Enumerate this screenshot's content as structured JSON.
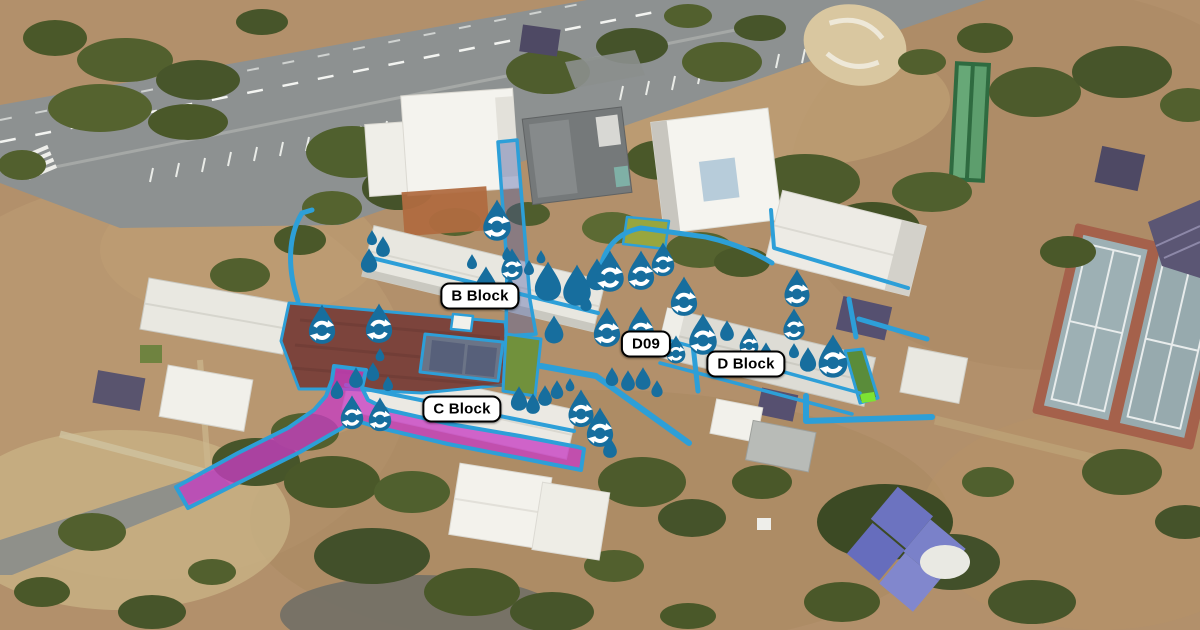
{
  "map": {
    "kind": "aerial-campus-map",
    "labels": [
      {
        "id": "b-block",
        "text": "B Block",
        "x": 480,
        "y": 296
      },
      {
        "id": "c-block",
        "text": "C Block",
        "x": 462,
        "y": 409
      },
      {
        "id": "d09",
        "text": "D09",
        "x": 646,
        "y": 344
      },
      {
        "id": "d-block",
        "text": "D Block",
        "x": 746,
        "y": 364
      }
    ],
    "colors": {
      "marker_blue": "#176e9e",
      "pipe_blue": "#2d9fd8",
      "path_magenta": "#c43ec2",
      "highlight_green": "#7de332",
      "label_background": "#ffffff",
      "label_border": "#000000",
      "label_text": "#000000"
    },
    "markers": [
      {
        "type": "water-drop",
        "x": 372,
        "y": 238,
        "size": 16
      },
      {
        "type": "water-drop",
        "x": 383,
        "y": 247,
        "size": 22
      },
      {
        "type": "water-drop",
        "x": 369,
        "y": 261,
        "size": 26
      },
      {
        "type": "recycle-drop",
        "x": 322,
        "y": 325,
        "size": 42
      },
      {
        "type": "recycle-drop",
        "x": 379,
        "y": 324,
        "size": 42
      },
      {
        "type": "water-drop",
        "x": 380,
        "y": 355,
        "size": 14
      },
      {
        "type": "water-drop",
        "x": 373,
        "y": 372,
        "size": 20
      },
      {
        "type": "water-drop",
        "x": 388,
        "y": 384,
        "size": 16
      },
      {
        "type": "water-drop",
        "x": 337,
        "y": 390,
        "size": 20
      },
      {
        "type": "water-drop",
        "x": 356,
        "y": 378,
        "size": 22
      },
      {
        "type": "recycle-drop",
        "x": 352,
        "y": 413,
        "size": 36
      },
      {
        "type": "recycle-drop",
        "x": 380,
        "y": 415,
        "size": 36
      },
      {
        "type": "recycle-drop",
        "x": 497,
        "y": 221,
        "size": 44
      },
      {
        "type": "water-drop",
        "x": 472,
        "y": 262,
        "size": 16
      },
      {
        "type": "water-drop",
        "x": 507,
        "y": 254,
        "size": 15
      },
      {
        "type": "recycle-drop",
        "x": 512,
        "y": 265,
        "size": 34
      },
      {
        "type": "water-drop",
        "x": 486,
        "y": 285,
        "size": 38
      },
      {
        "type": "water-drop",
        "x": 510,
        "y": 293,
        "size": 32
      },
      {
        "type": "water-drop",
        "x": 529,
        "y": 268,
        "size": 16
      },
      {
        "type": "water-drop",
        "x": 541,
        "y": 257,
        "size": 14
      },
      {
        "type": "water-drop",
        "x": 548,
        "y": 282,
        "size": 42
      },
      {
        "type": "water-drop",
        "x": 577,
        "y": 286,
        "size": 44
      },
      {
        "type": "water-drop",
        "x": 597,
        "y": 275,
        "size": 34
      },
      {
        "type": "recycle-drop",
        "x": 610,
        "y": 272,
        "size": 44
      },
      {
        "type": "recycle-drop",
        "x": 641,
        "y": 271,
        "size": 42
      },
      {
        "type": "recycle-drop",
        "x": 663,
        "y": 260,
        "size": 36
      },
      {
        "type": "recycle-drop",
        "x": 684,
        "y": 297,
        "size": 42
      },
      {
        "type": "recycle-drop",
        "x": 607,
        "y": 328,
        "size": 42
      },
      {
        "type": "recycle-drop",
        "x": 641,
        "y": 327,
        "size": 42
      },
      {
        "type": "water-drop",
        "x": 586,
        "y": 303,
        "size": 18
      },
      {
        "type": "water-drop",
        "x": 554,
        "y": 330,
        "size": 30
      },
      {
        "type": "recycle-drop",
        "x": 676,
        "y": 350,
        "size": 30
      },
      {
        "type": "recycle-drop",
        "x": 703,
        "y": 335,
        "size": 44
      },
      {
        "type": "water-drop",
        "x": 727,
        "y": 331,
        "size": 22
      },
      {
        "type": "recycle-drop",
        "x": 749,
        "y": 342,
        "size": 30
      },
      {
        "type": "water-drop",
        "x": 766,
        "y": 356,
        "size": 28
      },
      {
        "type": "recycle-drop",
        "x": 797,
        "y": 289,
        "size": 40
      },
      {
        "type": "recycle-drop",
        "x": 794,
        "y": 325,
        "size": 34
      },
      {
        "type": "water-drop",
        "x": 794,
        "y": 351,
        "size": 16
      },
      {
        "type": "water-drop",
        "x": 808,
        "y": 360,
        "size": 26
      },
      {
        "type": "recycle-drop",
        "x": 833,
        "y": 357,
        "size": 46
      },
      {
        "type": "water-drop",
        "x": 612,
        "y": 377,
        "size": 20
      },
      {
        "type": "water-drop",
        "x": 628,
        "y": 381,
        "size": 22
      },
      {
        "type": "water-drop",
        "x": 643,
        "y": 379,
        "size": 24
      },
      {
        "type": "water-drop",
        "x": 657,
        "y": 389,
        "size": 18
      },
      {
        "type": "water-drop",
        "x": 519,
        "y": 399,
        "size": 26
      },
      {
        "type": "water-drop",
        "x": 533,
        "y": 404,
        "size": 22
      },
      {
        "type": "water-drop",
        "x": 545,
        "y": 396,
        "size": 22
      },
      {
        "type": "water-drop",
        "x": 557,
        "y": 390,
        "size": 20
      },
      {
        "type": "water-drop",
        "x": 570,
        "y": 385,
        "size": 14
      },
      {
        "type": "recycle-drop",
        "x": 581,
        "y": 409,
        "size": 40
      },
      {
        "type": "recycle-drop",
        "x": 600,
        "y": 428,
        "size": 42
      },
      {
        "type": "water-drop",
        "x": 610,
        "y": 448,
        "size": 22
      }
    ]
  }
}
